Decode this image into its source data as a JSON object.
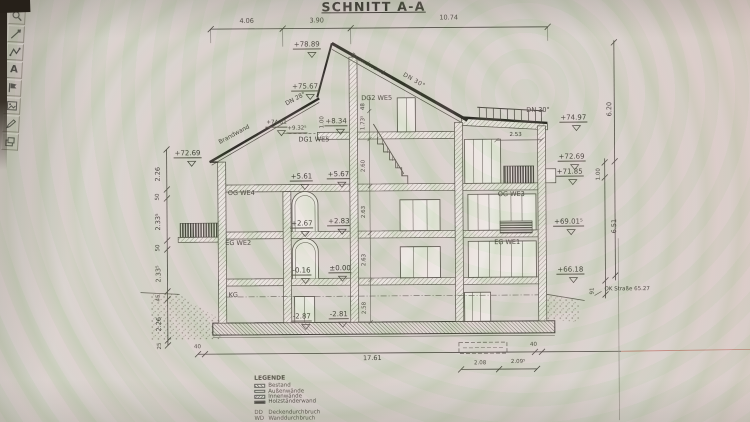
{
  "app": {
    "toolbar": {
      "text_tool_glyph": "A",
      "icons": [
        "zoom",
        "measure",
        "polyline",
        "text",
        "flag",
        "image",
        "draw",
        "layers"
      ]
    }
  },
  "drawing": {
    "title": "SCHNITT A-A",
    "top_dims": [
      "4.06",
      "3.90",
      "10.74"
    ],
    "left_dims": [
      "2.26",
      "50",
      "2.33⁵",
      "50",
      "2.33⁵",
      "45",
      "2.26",
      "25"
    ],
    "right_dims": [
      "6.20",
      "1.00",
      "6.51",
      "91"
    ],
    "inner_dims": [
      "48",
      "1.73⁵",
      "1.00",
      "2.60",
      "2.63",
      "2.63",
      "2.58",
      "2.53"
    ],
    "bottom_dims": [
      "40",
      "17.61",
      "40",
      "2.08",
      "2.09⁵"
    ],
    "roof": {
      "brandwand_right": "Brandwand",
      "brandwand_left": "Brandwand",
      "dn28": "DN 28°",
      "dn30_main": "DN 30°",
      "dn30_annex": "DN 30°"
    },
    "levels": {
      "ridge": "+78.89",
      "upper_left": "+75.67",
      "mid_left": "+74.81",
      "eave_left": "+72.69",
      "annex_roof": "+74.97",
      "right_7269": "+72.69",
      "right_7185": "+71.85",
      "right_6901": "+69.01⁵",
      "right_6618": "+66.18",
      "street": "OK Straße 65.27"
    },
    "rel_levels": {
      "p932": "+9.32⁵",
      "p834": "+8.34",
      "p561": "+5.61",
      "p567": "+5.67",
      "p267": "+2.67",
      "p283": "+2.83",
      "m016": "-0.16",
      "pm000": "±0.00",
      "m287": "-2.87",
      "m281": "-2.81"
    },
    "rooms": {
      "dg2": "DG2 WE5",
      "dg1": "DG1 WE5",
      "og_we4": "OG WE4",
      "eg_we2": "EG WE2",
      "kg": "KG",
      "og_we3": "OG WE3",
      "eg_we1": "EG WE1"
    },
    "legend": {
      "title": "LEGENDE",
      "items": [
        "Bestand",
        "Außenwände",
        "Innenwände",
        "Holzständerwand"
      ],
      "abbr": [
        {
          "key": "DD",
          "label": "Deckendurchbruch"
        },
        {
          "key": "WD",
          "label": "Wanddurchbruch"
        }
      ]
    }
  }
}
